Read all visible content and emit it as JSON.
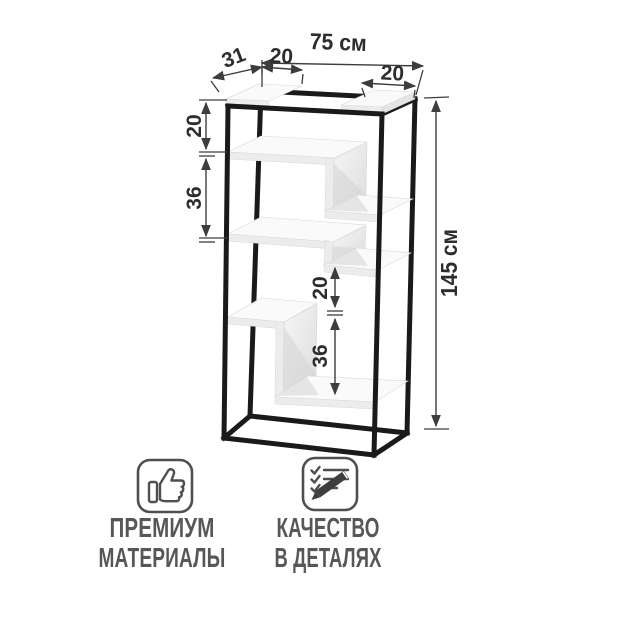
{
  "diagram": {
    "title": "shelving-unit-dimension-drawing",
    "dimensions": {
      "top_width": "75 см",
      "depth": "31",
      "top_left_shelf_width": "20",
      "top_right_shelf_width": "20",
      "left_gap_top": "20",
      "left_gap_middle": "36",
      "inner_gap_top": "20",
      "inner_gap_bottom": "36",
      "height": "145 см"
    },
    "colors": {
      "frame": "#1a1a1a",
      "shelf": "#fafafa",
      "dimension_text": "#2d2d2d",
      "feature_text": "#575757",
      "background": "#ffffff"
    }
  },
  "features": [
    {
      "icon": "thumbs-up-icon",
      "line1": "ПРЕМИУМ",
      "line2": "МАТЕРИАЛЫ"
    },
    {
      "icon": "checklist-pencil-icon",
      "line1": "КАЧЕСТВО",
      "line2": "В ДЕТАЛЯХ"
    }
  ]
}
